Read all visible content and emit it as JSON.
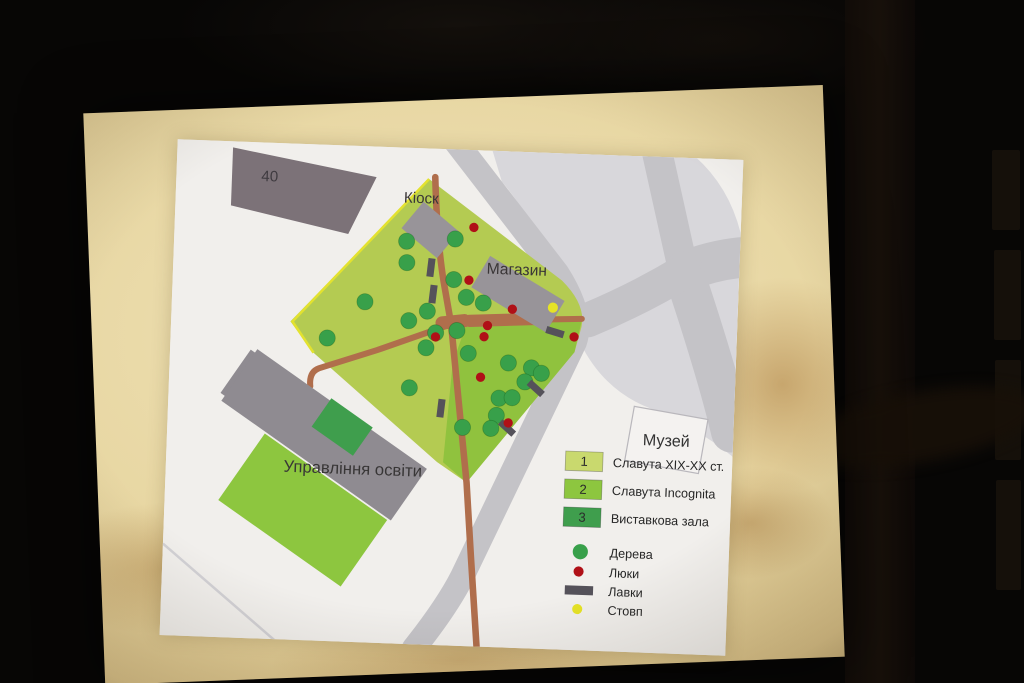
{
  "map": {
    "labels": {
      "building40": "40",
      "kiosk": "Кіоск",
      "shop": "Магазин",
      "education": "Управління освіти",
      "museum": "Музей"
    },
    "legend": {
      "zones": [
        {
          "num": "1",
          "label": "Славута XIX-XX ст.",
          "color": "#c9d96e"
        },
        {
          "num": "2",
          "label": "Славута Incognita",
          "color": "#8dc63f"
        },
        {
          "num": "3",
          "label": "Виставкова зала",
          "color": "#3f9e4d"
        }
      ],
      "symbols": [
        {
          "type": "tree",
          "label": "Дерева",
          "color": "#38a04a"
        },
        {
          "type": "manhole",
          "label": "Люки",
          "color": "#b01017"
        },
        {
          "type": "bench",
          "label": "Лавки",
          "color": "#55525a"
        },
        {
          "type": "pole",
          "label": "Стовп",
          "color": "#e6e326"
        }
      ]
    },
    "colors": {
      "zone1": "#c9d96e",
      "zone2": "#8dc63f",
      "zone3": "#3f9e4d",
      "tree": "#38a04a",
      "manhole": "#b01017",
      "bench": "#55525a",
      "pole": "#e6e326",
      "path": "#b06e4c"
    },
    "features": {
      "trees": [
        [
          278,
          88
        ],
        [
          230,
          92
        ],
        [
          231,
          113
        ],
        [
          278,
          128
        ],
        [
          291,
          145
        ],
        [
          308,
          150
        ],
        [
          253,
          160
        ],
        [
          235,
          170
        ],
        [
          191,
          153
        ],
        [
          155,
          190
        ],
        [
          262,
          181
        ],
        [
          283,
          178
        ],
        [
          295,
          200
        ],
        [
          253,
          196
        ],
        [
          238,
          236
        ],
        [
          335,
          208
        ],
        [
          358,
          212
        ],
        [
          368,
          217
        ],
        [
          352,
          226
        ],
        [
          327,
          243
        ],
        [
          340,
          242
        ],
        [
          325,
          260
        ],
        [
          292,
          273
        ],
        [
          320,
          273
        ]
      ],
      "manholes": [
        [
          296,
          76
        ],
        [
          293,
          128
        ],
        [
          337,
          155
        ],
        [
          313,
          172
        ],
        [
          310,
          183
        ],
        [
          262,
          185
        ],
        [
          399,
          180
        ],
        [
          308,
          223
        ],
        [
          337,
          267
        ]
      ],
      "benches": [
        [
          255,
          117,
          95
        ],
        [
          258,
          143,
          95
        ],
        [
          380,
          176,
          15
        ],
        [
          363,
          232,
          40
        ],
        [
          336,
          272,
          40
        ],
        [
          270,
          255,
          95
        ]
      ],
      "poles": [
        [
          377,
          152
        ]
      ]
    }
  }
}
